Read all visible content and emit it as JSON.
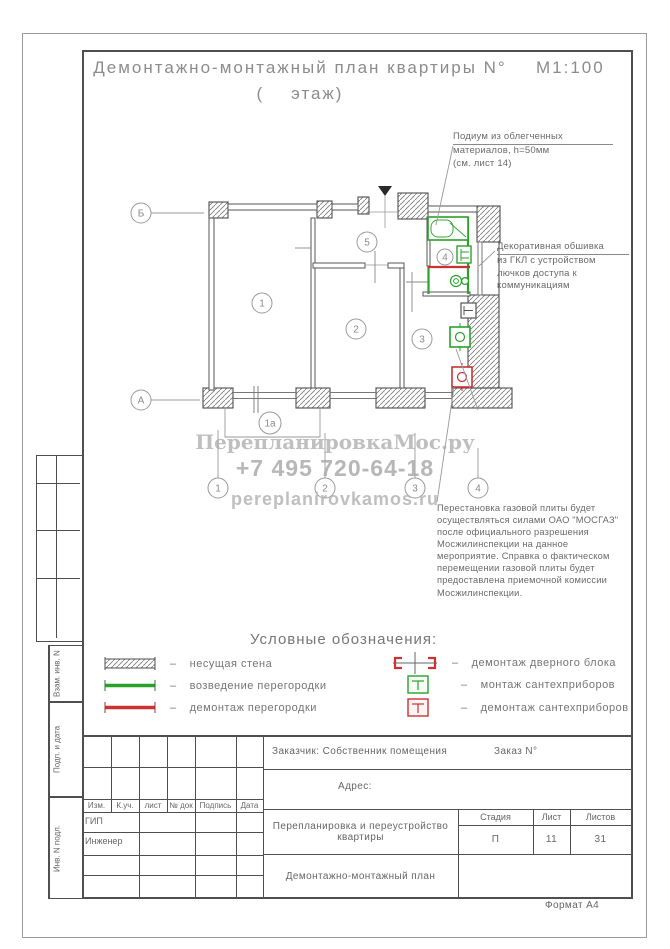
{
  "title": {
    "line1": "Демонтажно-монтажный план квартиры N°",
    "scale": "М1:100",
    "line2": "(    этаж)"
  },
  "watermark": {
    "l1": "ПерепланировкаМос.ру",
    "l2": "+7 495 720-64-18",
    "l3": "pereplanirovkamos.ru"
  },
  "notes": {
    "podium": {
      "line1": "Подиум из облегченных",
      "rest": "материалов, h=50мм\n(см. лист 14)"
    },
    "cladding": {
      "line1": "Декоративная обшивка",
      "rest": "из ГКЛ с устройством\nлючков доступа к\nкоммуникациям"
    },
    "gas": {
      "text": "Перестановка газовой плиты будет\nосуществляться силами ОАО \"МОСГАЗ\"\nпосле официального разрешения\nМосжилинспекции на данное\nмероприятие. Справка о фактическом\nперемещении газовой плиты будет\nпредоставлена приемочной комиссии\nМосжилинспекции."
    }
  },
  "plan": {
    "rooms": [
      "1",
      "2",
      "3",
      "4",
      "5"
    ],
    "axis": {
      "b": "Б",
      "a": "А",
      "x1": "1",
      "x1a": "1а",
      "x2": "2",
      "x3": "3",
      "x4": "4"
    }
  },
  "legend": {
    "heading": "Условные обозначения:",
    "dash": "–",
    "left": [
      "несущая стена",
      "возведение перегородки",
      "демонтаж перегородки"
    ],
    "right": [
      "демонтаж дверного блока",
      "монтаж сантехприборов",
      "демонтаж сантехприборов"
    ]
  },
  "titleblock": {
    "customer": "Заказчик: Собственник помещения",
    "order": "Заказ N°",
    "address": "Адрес:",
    "headers": [
      "Изм.",
      "К.уч.",
      "лист",
      "№ док",
      "Подпись",
      "Дата"
    ],
    "roles": [
      "ГИП",
      "Инженер"
    ],
    "project": "Перепланировка и переустройство\nквартиры",
    "sheet_title": "Демонтажно-монтажный план",
    "stage_label": "Стадия",
    "sheet_label": "Лист",
    "sheets_label": "Листов",
    "stage": "П",
    "sheet": "11",
    "sheets": "31",
    "format": "Формат А4"
  },
  "sidebar": {
    "labels": [
      "Взам. инв. N",
      "Подп. и дата",
      "Инв. N подл."
    ]
  },
  "colors": {
    "new_work": "#2aa22a",
    "demolition": "#cc3232",
    "wall": "#4f4f4f"
  }
}
